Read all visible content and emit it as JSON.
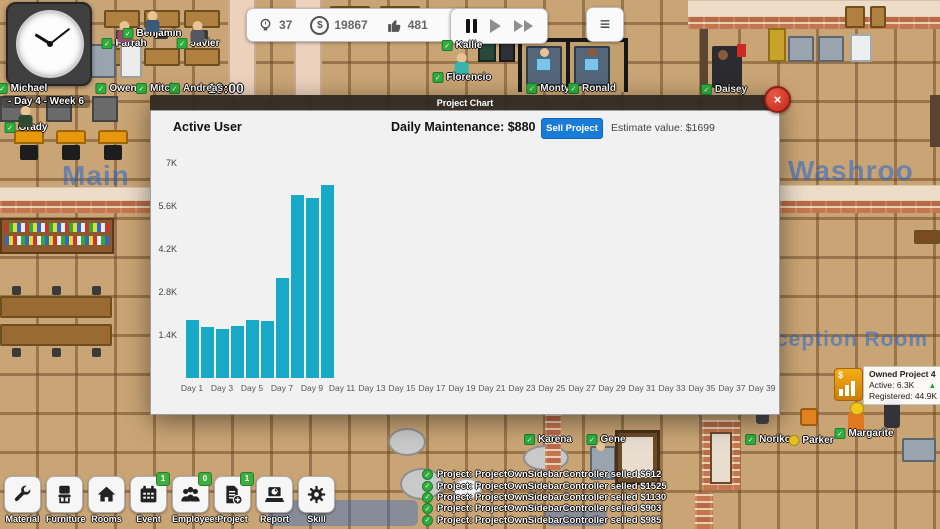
{
  "hud": {
    "time": "10:00",
    "date_label": "- Day 4 - Week 6",
    "menu_icon": "≡",
    "resources": [
      {
        "id": "idea",
        "icon": "bulb-icon",
        "value": "37"
      },
      {
        "id": "money",
        "icon": "money-icon",
        "value": "19867"
      },
      {
        "id": "likes",
        "icon": "thumbsup-icon",
        "value": "481"
      }
    ]
  },
  "room_labels": {
    "main": "Main",
    "washroom": "Washroo",
    "reception": "ception Room"
  },
  "modal": {
    "title": "Project Chart",
    "section_title": "Active User",
    "maintenance_label": "Daily Maintenance: $880",
    "sell_button_label": "Sell Project",
    "estimate_label": "Estimate value: $1699",
    "close_label": "×",
    "accent_color": "#1a7cd9"
  },
  "chart_data": {
    "type": "bar",
    "title": "Active User",
    "categories": [
      "Day 1",
      "Day 2",
      "Day 3",
      "Day 4",
      "Day 5",
      "Day 6",
      "Day 7",
      "Day 8",
      "Day 9",
      "Day 10"
    ],
    "values": [
      1900,
      1650,
      1600,
      1700,
      1900,
      1850,
      3250,
      5950,
      5850,
      6300
    ],
    "x_tick_labels": [
      "Day 1",
      "Day 3",
      "Day 5",
      "Day 7",
      "Day 9",
      "Day 11",
      "Day 13",
      "Day 15",
      "Day 17",
      "Day 19",
      "Day 21",
      "Day 23",
      "Day 25",
      "Day 27",
      "Day 29",
      "Day 31",
      "Day 33",
      "Day 35",
      "Day 37",
      "Day 39"
    ],
    "y_tick_labels": [
      "7K",
      "5.6K",
      "4.2K",
      "2.8K",
      "1.4K"
    ],
    "ylim": [
      0,
      7000
    ],
    "grid": false,
    "bar_color": "#18a9c9",
    "xlabel": "",
    "ylabel": ""
  },
  "toolbar": {
    "badge_color": "#3fae3f",
    "items": [
      {
        "label": "Material",
        "icon": "wrench-icon"
      },
      {
        "label": "Furniture",
        "icon": "chair-icon"
      },
      {
        "label": "Rooms",
        "icon": "house-icon"
      },
      {
        "label": "Event",
        "icon": "calendar-icon",
        "badge": "1"
      },
      {
        "label": "Employees",
        "icon": "people-icon",
        "badge": "0"
      },
      {
        "label": "Project",
        "icon": "document-add-icon",
        "badge": "1"
      },
      {
        "label": "Report",
        "icon": "report-icon"
      },
      {
        "label": "Skill",
        "icon": "gear-icon"
      }
    ]
  },
  "project_panel": {
    "title": "Owned Project 4",
    "active_label": "Active: 6.3K",
    "registered_label": "Registered: 44.9K",
    "trend_icon": "▲"
  },
  "log": {
    "entries": [
      "Project: ProjectOwnSidebarController selled $612",
      "Project: ProjectOwnSidebarController selled $1525",
      "Project: ProjectOwnSidebarController selled $1130",
      "Project: ProjectOwnSidebarController selled $903",
      "Project: ProjectOwnSidebarController selled $985"
    ]
  },
  "characters": [
    {
      "name": "Michael",
      "x": 22,
      "y": 83,
      "status": "green"
    },
    {
      "name": "Farrah",
      "x": 124,
      "y": 38,
      "status": "green",
      "sprite": true,
      "sdy": -17,
      "body": "#9a4a6a"
    },
    {
      "name": "Benjamin",
      "x": 152,
      "y": 28,
      "status": "green",
      "sprite": true,
      "sdy": -17,
      "body": "#3a5a7a"
    },
    {
      "name": "Javier",
      "x": 198,
      "y": 38,
      "status": "green",
      "sprite": true,
      "sdy": -17,
      "body": "#55585e"
    },
    {
      "name": "Owen",
      "x": 116,
      "y": 83,
      "status": "green"
    },
    {
      "name": "Mitch",
      "x": 156,
      "y": 83,
      "status": "green"
    },
    {
      "name": "Andreas",
      "x": 196,
      "y": 83,
      "status": "green"
    },
    {
      "name": "Grady",
      "x": 26,
      "y": 122,
      "status": "green",
      "sprite": true,
      "sdy": -16,
      "body": "#2e4a2e"
    },
    {
      "name": "Kallie",
      "x": 462,
      "y": 40,
      "status": "green",
      "sprite": true,
      "sdy": 13,
      "body": "#35b5ad"
    },
    {
      "name": "Florencio",
      "x": 462,
      "y": 72,
      "status": "green"
    },
    {
      "name": "Monty",
      "x": 548,
      "y": 83,
      "status": "green"
    },
    {
      "name": "Ronald",
      "x": 592,
      "y": 83,
      "status": "green"
    },
    {
      "name": "Daisey",
      "x": 724,
      "y": 84,
      "status": "green"
    },
    {
      "name": "Karena",
      "x": 548,
      "y": 434,
      "status": "green"
    },
    {
      "name": "Gene",
      "x": 606,
      "y": 434,
      "status": "green"
    },
    {
      "name": "Noriko",
      "x": 768,
      "y": 434,
      "status": "green"
    },
    {
      "name": "Parker",
      "x": 811,
      "y": 435,
      "status": "yellow"
    },
    {
      "name": "Margarite",
      "x": 864,
      "y": 428,
      "status": "green"
    }
  ]
}
